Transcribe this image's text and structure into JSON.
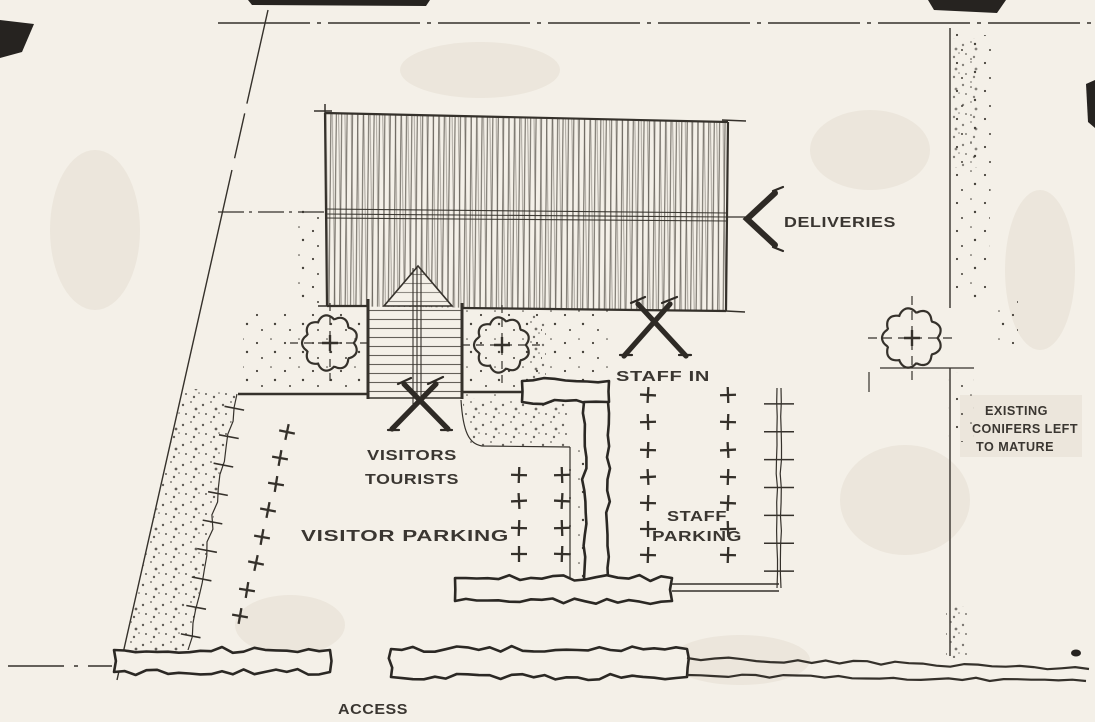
{
  "labels": {
    "deliveries": "DELIVERIES",
    "staff_in": "STAFF IN",
    "visitors_line1": "VISITORS",
    "visitors_line2": "TOURISTS",
    "visitor_parking": "VISITOR PARKING",
    "staff_parking_line1": "STAFF",
    "staff_parking_line2": "PARKING",
    "existing_conifers_line1": "EXISTING",
    "existing_conifers_line2": "CONIFERS LEFT",
    "existing_conifers_line3": "TO MATURE",
    "access": "ACCESS"
  },
  "icons": {
    "deliveries_arrow": "chevron-left-arrow",
    "staff_entry_marker": "x-cross-marker",
    "visitors_entry_marker": "x-cross-marker",
    "tree": "scalloped-circle-with-crosshair",
    "parking_space": "plus-cross",
    "conifer_planting": "stipple-dots"
  },
  "colors": {
    "paper": "#f4f0e8",
    "ink": "#35312b",
    "shade": "#ded7c8",
    "artifact_black": "#262320"
  }
}
